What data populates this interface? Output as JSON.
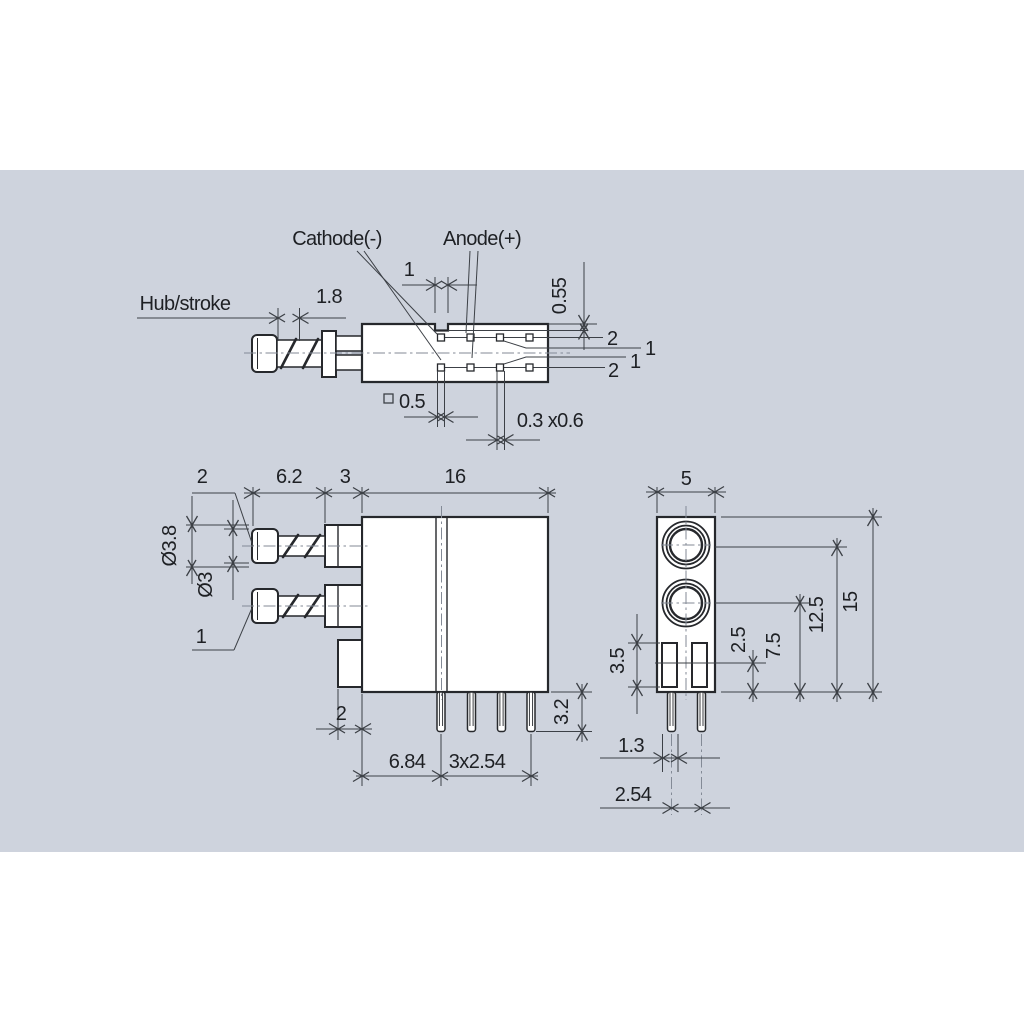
{
  "canvas": {
    "background": "#ffffff",
    "panel_color": "#ced3dd",
    "line_color": "#26282c",
    "dim_line_color": "#3c4046",
    "centerline_color": "#838a96",
    "text_color": "#1e2024"
  },
  "labels": {
    "cathode": "Cathode(-)",
    "anode": "Anode(+)",
    "hub_stroke": "Hub/stroke"
  },
  "side_view": {
    "dims": {
      "stroke": "1.8",
      "notch_width": "1",
      "notch_depth": "0.55",
      "pad_size": "0.5",
      "pin_section": "0.3 x0.6"
    },
    "pin_callouts": [
      "2",
      "1",
      "1",
      "2"
    ]
  },
  "front_view": {
    "dims": {
      "cap_callout": "2",
      "plunger_len": "6.2",
      "collar_len": "3",
      "body_len": "16",
      "cap_dia": "Ø3.8",
      "shaft_dia": "Ø3",
      "button_callout": "1",
      "tab_width": "2",
      "pin_offset": "6.84",
      "pin_pitch": "3x2.54",
      "pin_length": "3.2"
    }
  },
  "end_view": {
    "dims": {
      "width": "5",
      "height": "15",
      "button1_height": "12.5",
      "button2_height": "7.5",
      "window_offset": "2.5",
      "window_height": "3.5",
      "window_width": "1.3",
      "pin_pitch": "2.54"
    }
  }
}
